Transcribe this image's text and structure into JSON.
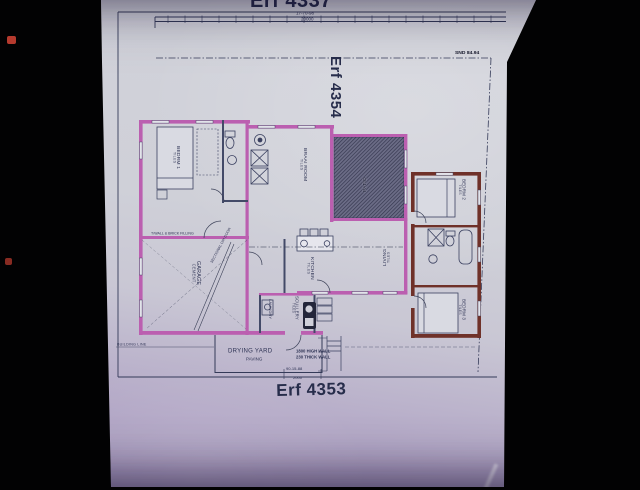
{
  "erfs": {
    "top": "Erf 4337",
    "site": "Erf 4354",
    "bottom": "Erf 4353"
  },
  "survey": {
    "top_bearing": "17-70-98",
    "top_distance": "20000",
    "corner_marker": "SND 84.94",
    "building_line": "BUILDING LINE",
    "bottom_bearing": "90-15-88",
    "bottom_distance": "2000"
  },
  "rooms": {
    "bedrm1": {
      "name": "BEDRM 1",
      "finish": "TILES"
    },
    "braai": {
      "name": "BRAAI ROOM",
      "finish": "TILES"
    },
    "patio": {
      "name": "PATIO",
      "finish": ""
    },
    "living": {
      "name": "LIVING",
      "finish": "TILES"
    },
    "kitchen": {
      "name": "KITCHEN",
      "finish": "TILES"
    },
    "scullery": {
      "name": "SCULLERY",
      "finish": "TILES"
    },
    "laundry": {
      "name": "LAUNDRY",
      "finish": ""
    },
    "garage": {
      "name": "GARAGE",
      "finish": "CEMENT"
    },
    "bedrm2": {
      "name": "BEDRM 2",
      "finish": "TILES"
    },
    "bedrm3": {
      "name": "BEDRM 3",
      "finish": "TILES"
    },
    "drying": {
      "name": "DRYING YARD",
      "finish": "PAVING"
    }
  },
  "notes": {
    "garage_wall": "T/WALL & BRICK FILLING",
    "garage_door": "SECTIONAL O/H DOOR",
    "yard_wall_1": "1800 HIGH WALL",
    "yard_wall_2": "230 THICK WALL"
  },
  "icons": {
    "bed": "rect-outline",
    "toilet": "ellipse+cistern",
    "bathtub": "rounded-rect",
    "basin": "circle",
    "stove": "square-row",
    "sink": "circle-in-rect",
    "cupboard": "x-box",
    "door": "quarter-arc",
    "geyser": "double-circle",
    "steps": "stacked-rects"
  },
  "colors": {
    "photo_bg": "#020203",
    "paper": "#cdced6",
    "paper_shadow": "#a093b8",
    "ink": "#343a58",
    "wall_primary": "#bb5fb0",
    "wall_secondary": "#6f3129",
    "patio_fill": "#6b6c86",
    "patio_hatch": "#34364e",
    "red_dot": "#b53a2e"
  }
}
